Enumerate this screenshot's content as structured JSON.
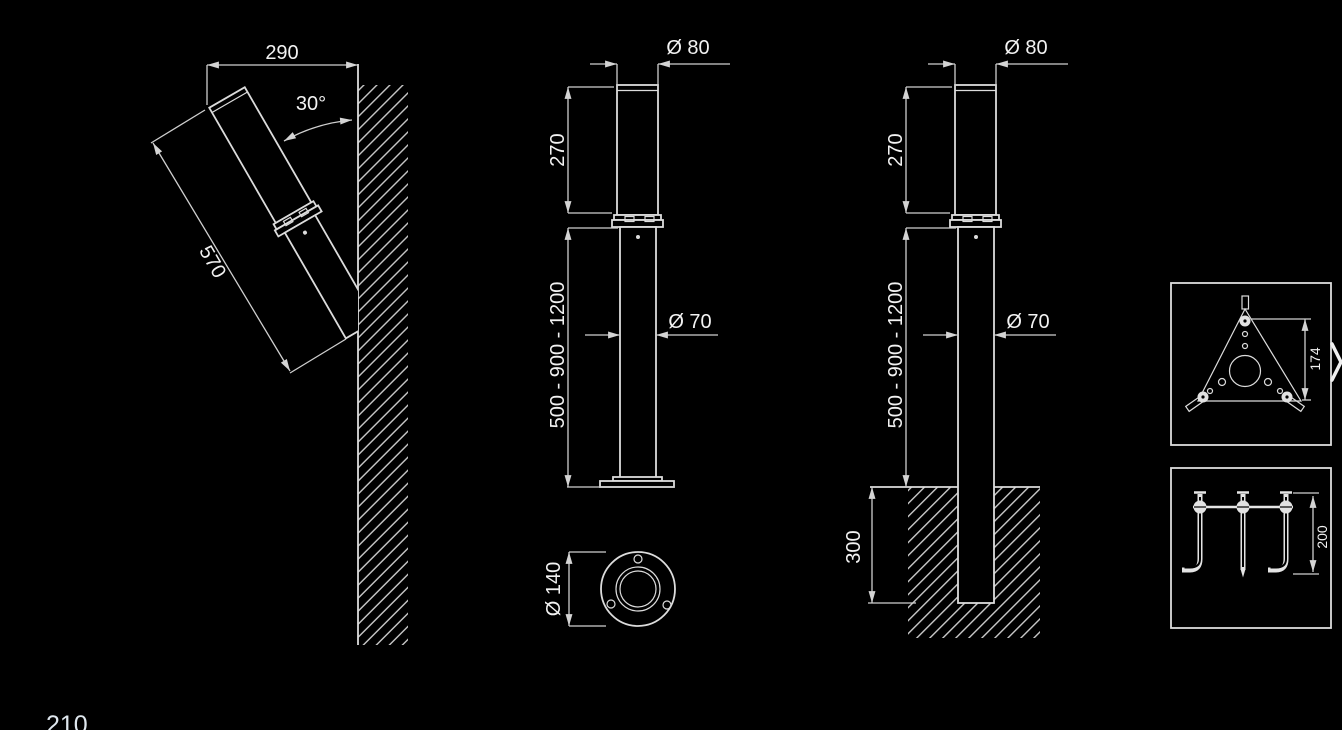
{
  "page": {
    "number": "210",
    "background_color": "#000000",
    "line_color": "#dcdcdc",
    "text_color": "#f2f2f2"
  },
  "views": {
    "wall_mounted": {
      "projection_width": "290",
      "tilt_angle": "30°",
      "fixture_length": "570"
    },
    "surface_mounted": {
      "head_diameter": "Ø 80",
      "head_height": "270",
      "pole_height_options": "500 - 900 - 1200",
      "pole_diameter": "Ø 70",
      "base_plate_diameter": "Ø 140"
    },
    "ground_mounted": {
      "head_diameter": "Ø 80",
      "head_height": "270",
      "pole_height_options": "500 - 900 - 1200",
      "pole_diameter": "Ø 70",
      "embedment_depth": "300"
    },
    "details": {
      "mounting_plate_height": "174",
      "anchor_bolt_length": "200"
    }
  },
  "controls": {
    "next_arrow_name": "carousel-next"
  }
}
